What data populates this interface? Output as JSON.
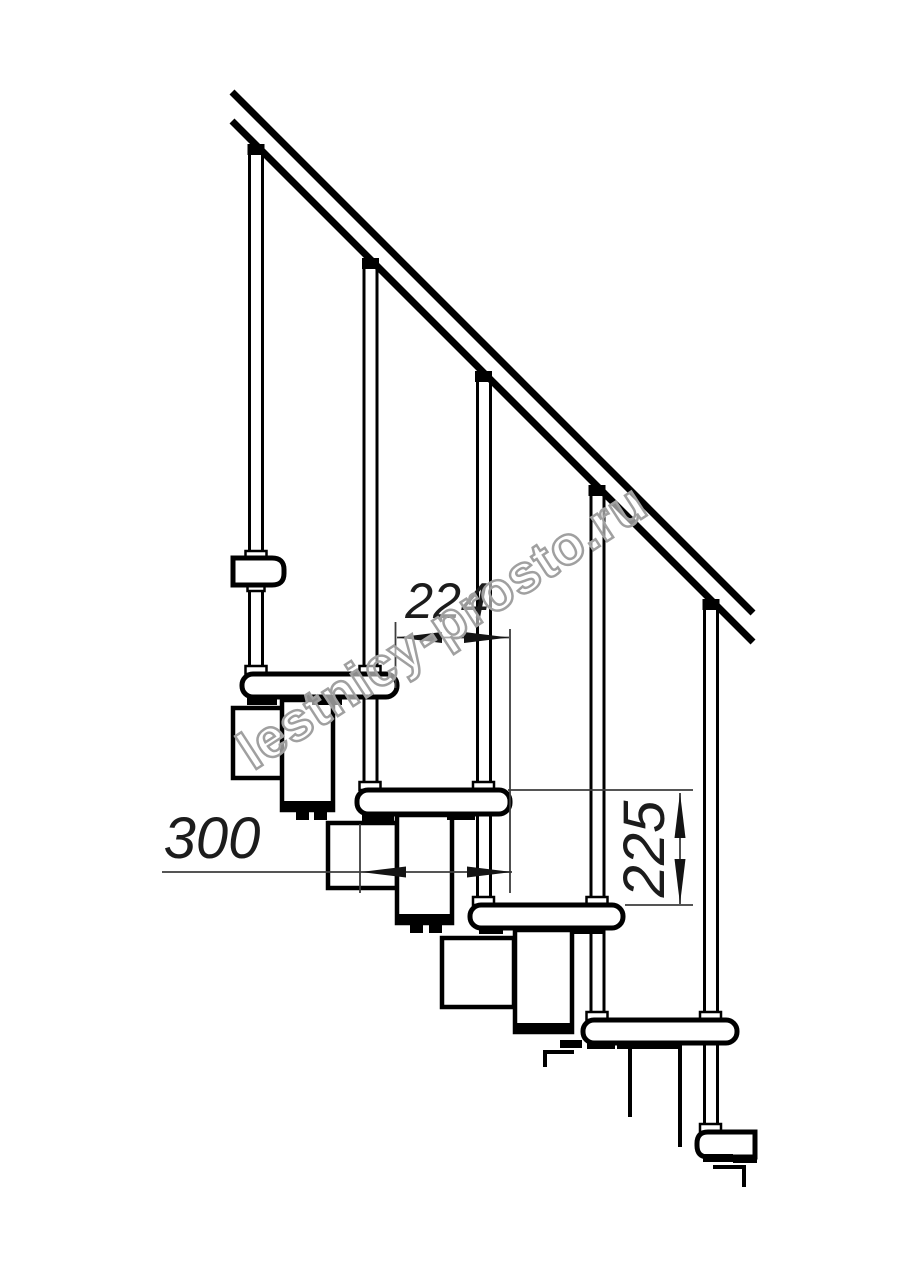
{
  "drawing": {
    "dimensions": {
      "going": {
        "value": "224"
      },
      "tread_depth": {
        "value": "300"
      },
      "rise": {
        "value": "225"
      }
    },
    "watermark": {
      "text": "lestnicy-prosto.ru"
    },
    "colors": {
      "background": "#ffffff",
      "outline": "#000000",
      "dimension_line": "#3d3d3d",
      "dimension_arrow": "#141414",
      "dimension_text": "#1c1c1c",
      "watermark_stroke": "#a0a0a0",
      "watermark_fill": "rgba(255,255,255,0.55)"
    }
  }
}
